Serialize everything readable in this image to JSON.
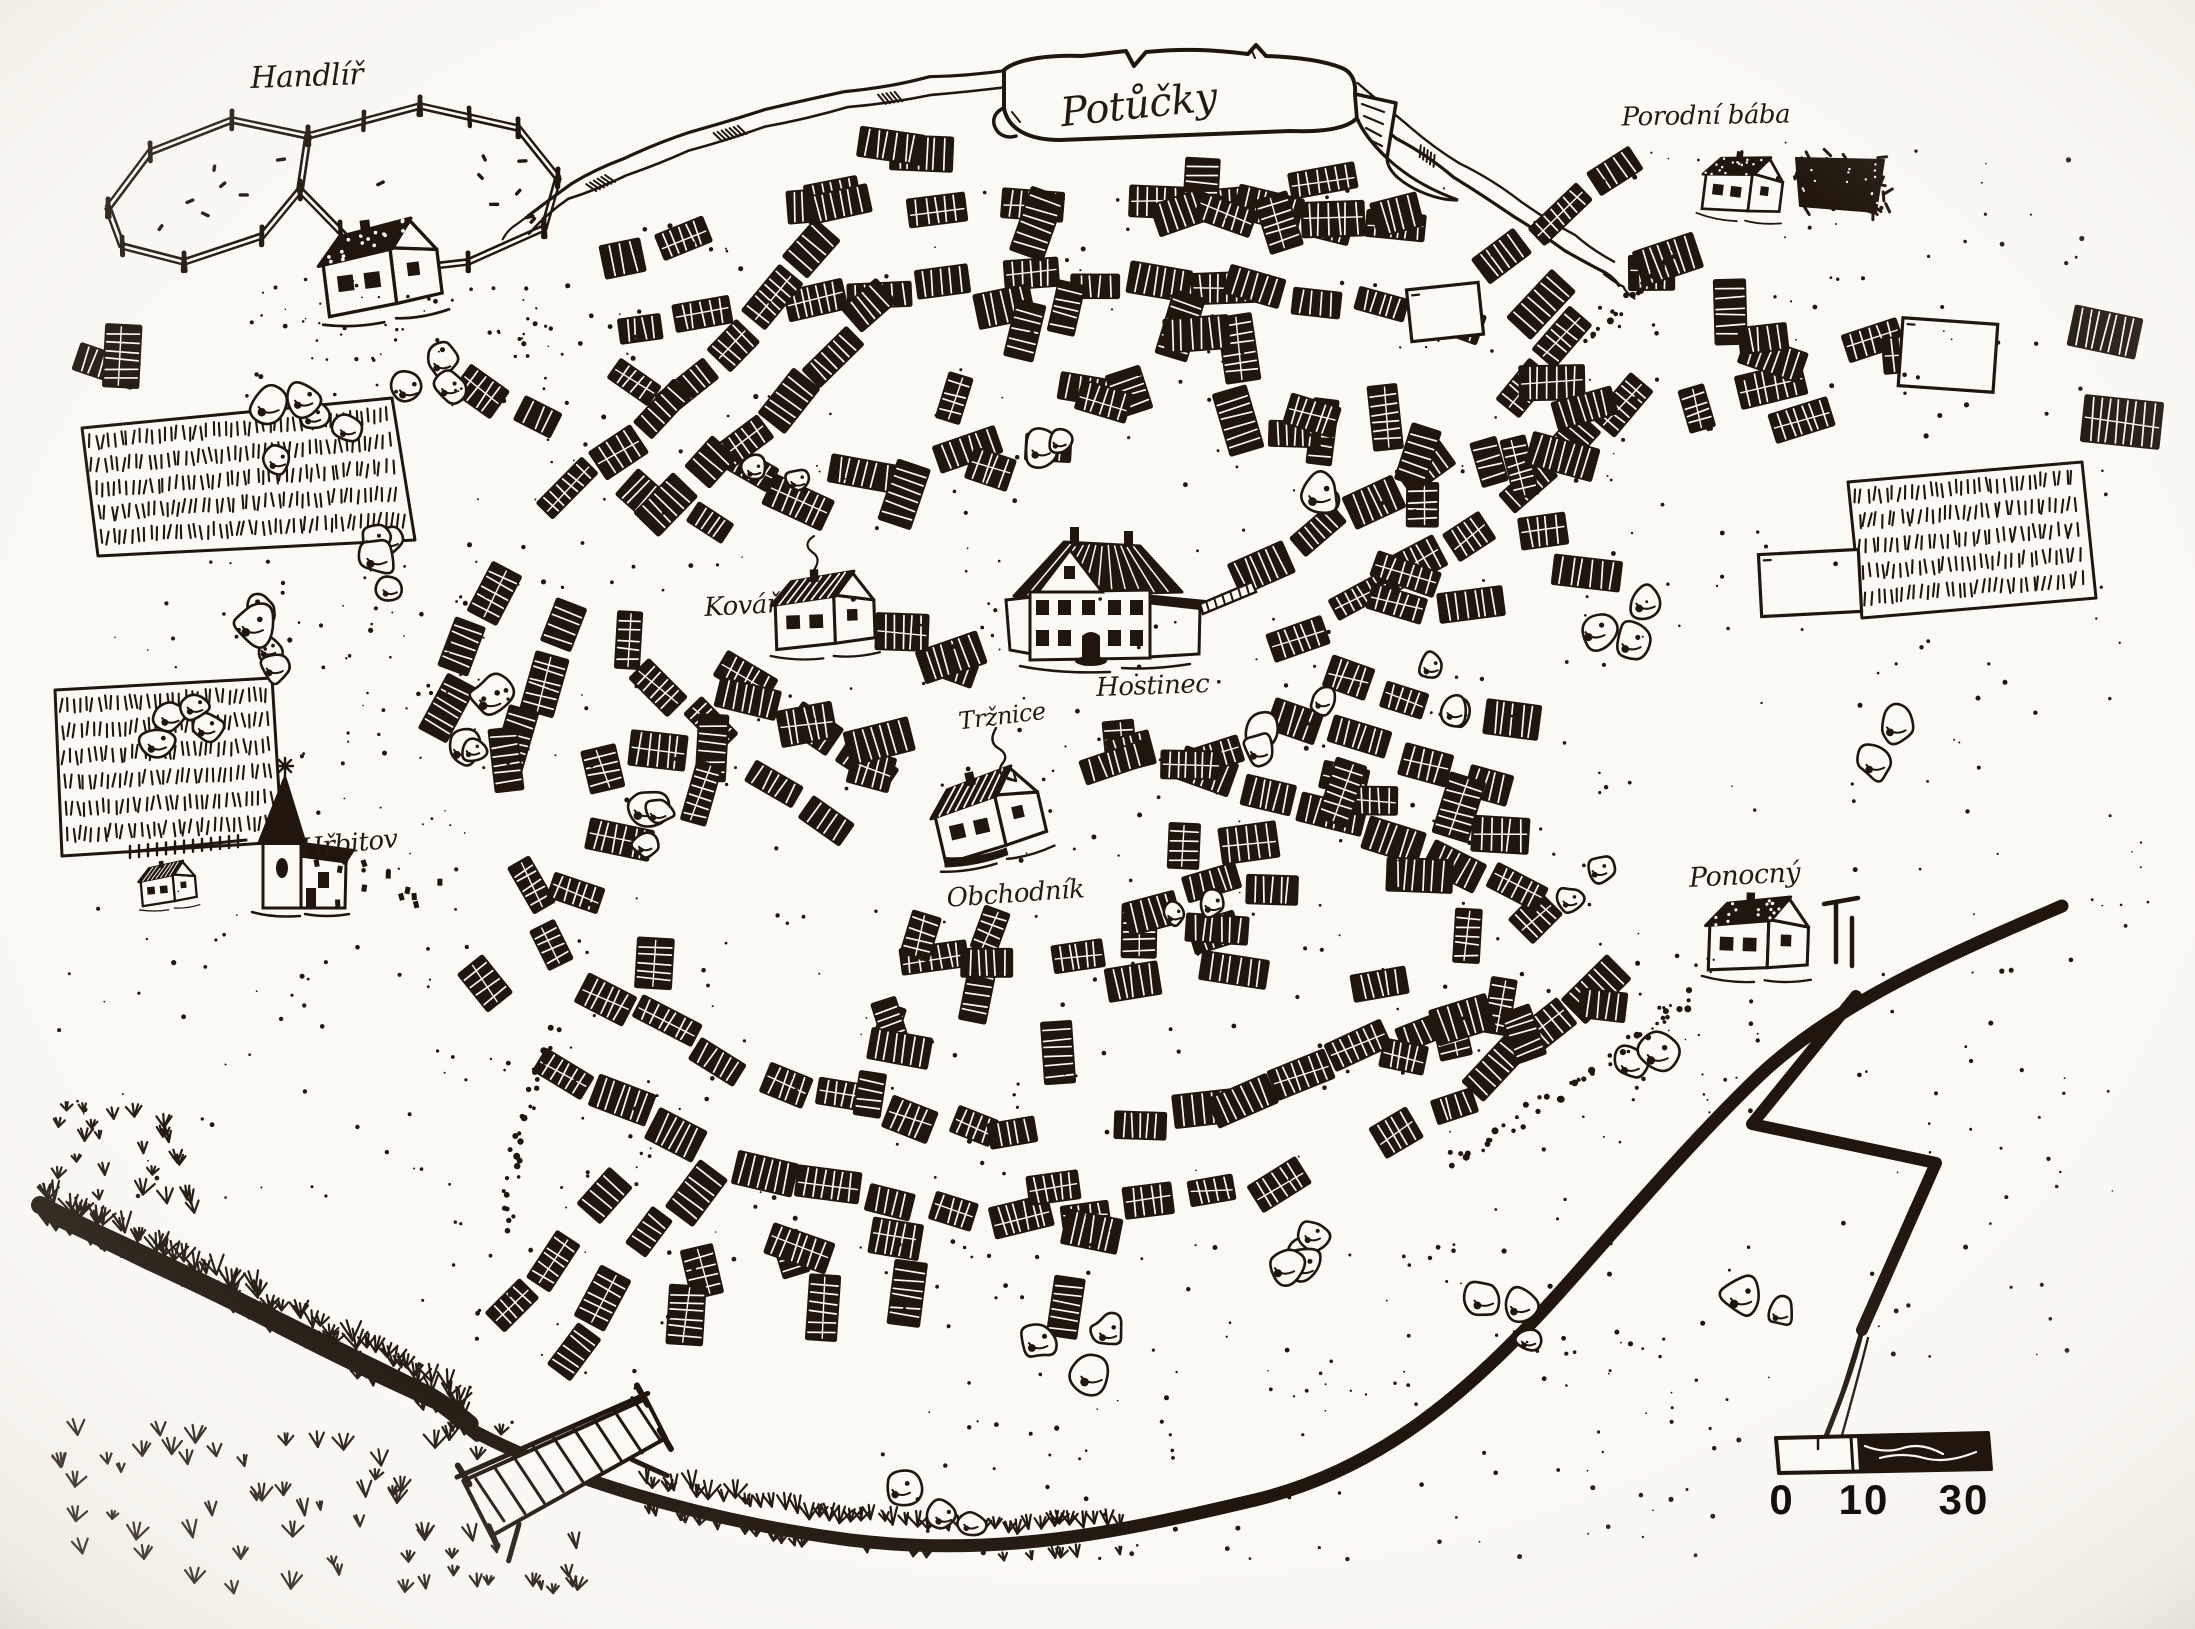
{
  "map_title": "Potůčky",
  "labels": {
    "banner_title": "Potůčky",
    "handlir": "Handlíř",
    "porodni_baba": "Porodní bába",
    "kovar": "Kovář",
    "hostinec": "Hostinec",
    "trznice": "Tržnice",
    "obchodnik": "Obchodník",
    "hrbitov": "Hřbitov",
    "ponocny": "Ponocný"
  },
  "scale_bar": {
    "ticks": [
      "0",
      "10",
      "30"
    ]
  },
  "colors": {
    "ink": "#20160d",
    "paper": "#fbf9f4"
  }
}
